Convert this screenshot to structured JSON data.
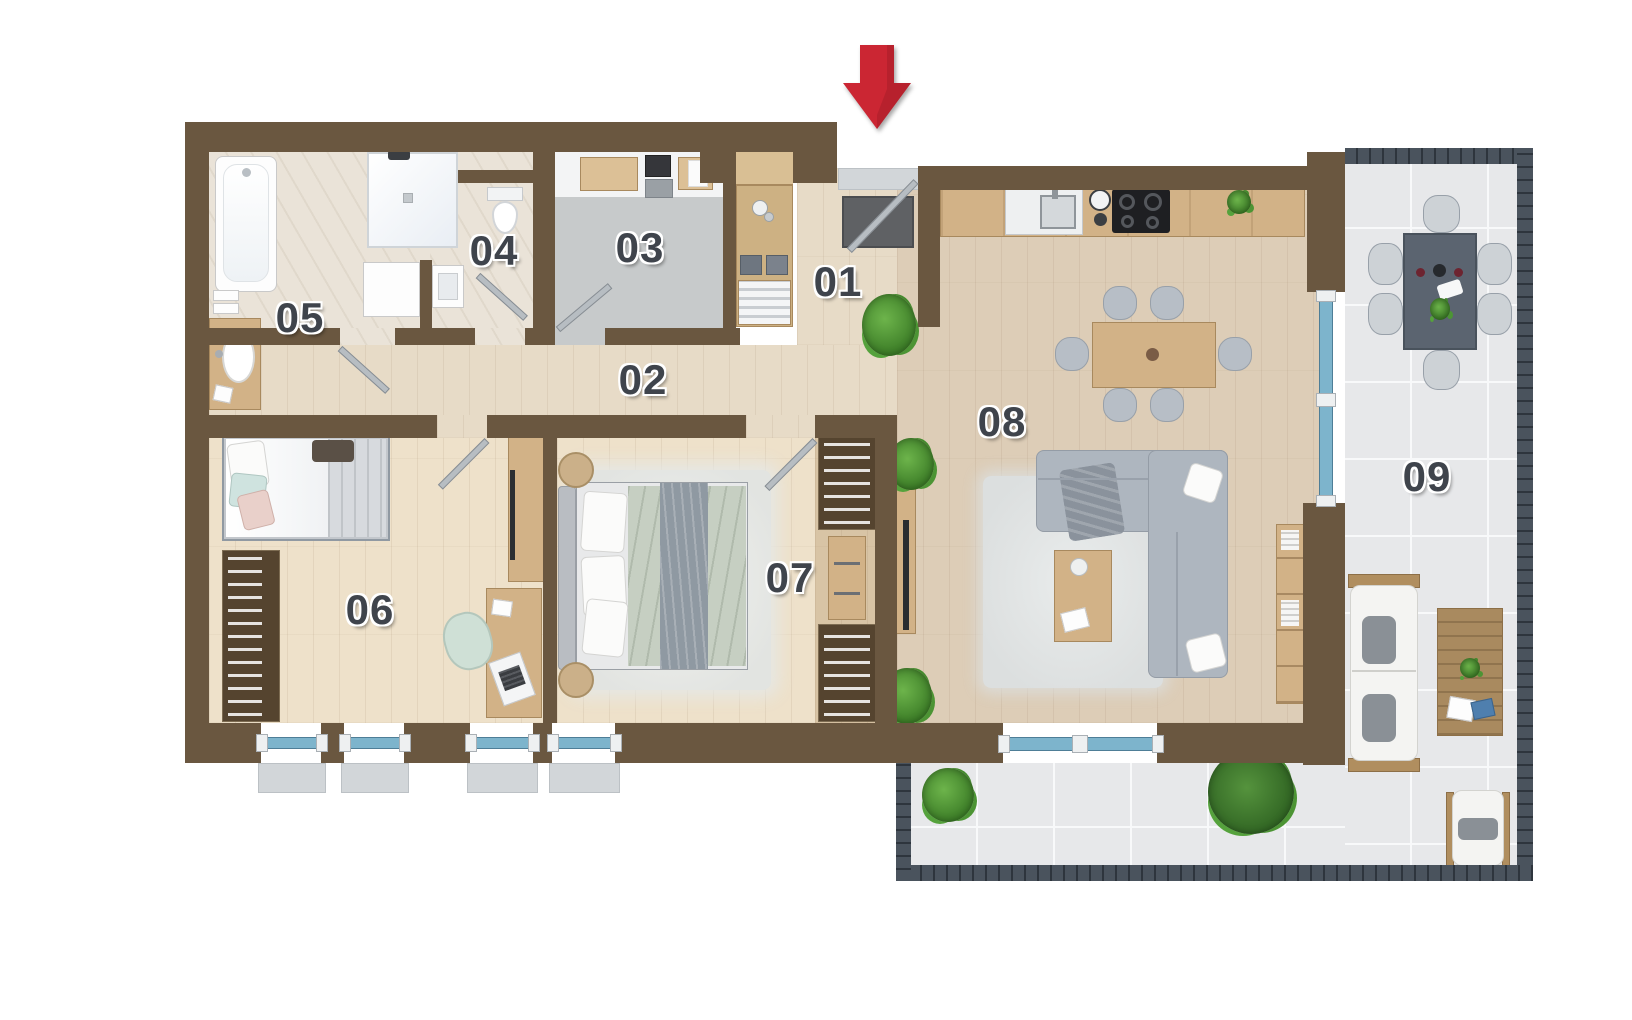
{
  "palette": {
    "wall": "#6a5740",
    "wood_a": "#e7dbc7",
    "wood_b": "#ddcdb7",
    "wood_c": "#eee1ca",
    "wood_d": "#d8c4a5",
    "wood_furn": "#d2b287",
    "marble": "#eae3d8",
    "utility": "#c7cacb",
    "tile": "#e7e8ea",
    "railing": "#4a535d",
    "glass": "#7db4cc",
    "arrow_red": "#cb2633",
    "label": "#3f444c"
  },
  "rooms": [
    {
      "id": "room-01",
      "label": "01"
    },
    {
      "id": "room-02",
      "label": "02"
    },
    {
      "id": "room-03",
      "label": "03"
    },
    {
      "id": "room-04",
      "label": "04"
    },
    {
      "id": "room-05",
      "label": "05"
    },
    {
      "id": "room-06",
      "label": "06"
    },
    {
      "id": "room-07",
      "label": "07"
    },
    {
      "id": "room-08",
      "label": "08"
    },
    {
      "id": "room-09",
      "label": "09"
    }
  ]
}
